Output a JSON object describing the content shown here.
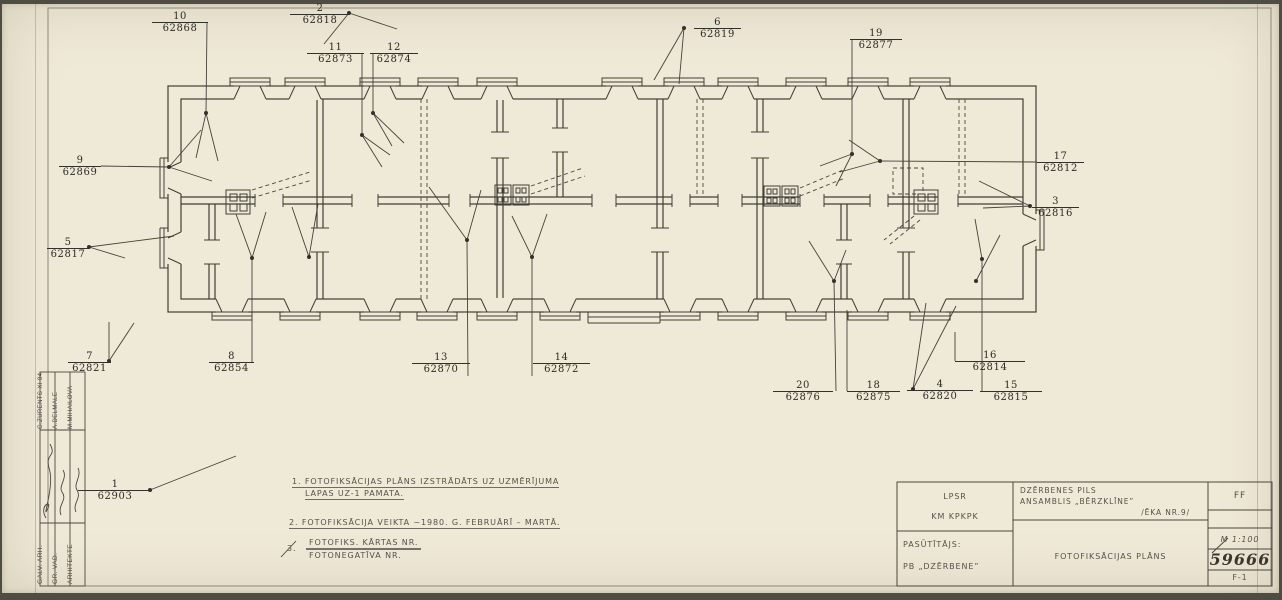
{
  "colors": {
    "paper": "#efe9d8",
    "line": "#413e36",
    "label_text": "#2d2b25",
    "hand_text": "#56524a"
  },
  "photo_points": [
    {
      "n": "1",
      "code": "62903",
      "x": 78,
      "y": 490,
      "w": 74,
      "dot": [
        150,
        490
      ],
      "leaders": [
        [
          [
            150,
            490
          ],
          [
            236,
            456
          ]
        ]
      ]
    },
    {
      "n": "2",
      "code": "62818",
      "x": 290,
      "y": 14,
      "w": 60,
      "dot": [
        349,
        13
      ],
      "leaders": [
        [
          [
            349,
            13
          ],
          [
            324,
            44
          ]
        ],
        [
          [
            349,
            13
          ],
          [
            397,
            29
          ]
        ]
      ]
    },
    {
      "n": "3",
      "code": "62816",
      "x": 1032,
      "y": 207,
      "w": 47,
      "dot": [
        1030,
        206
      ],
      "leaders": [
        [
          [
            1030,
            206
          ],
          [
            979,
            181
          ]
        ],
        [
          [
            1030,
            206
          ],
          [
            983,
            208
          ]
        ]
      ]
    },
    {
      "n": "4",
      "code": "62820",
      "x": 907,
      "y": 390,
      "w": 66,
      "dot": [
        913,
        389
      ],
      "leaders": [
        [
          [
            913,
            389
          ],
          [
            926,
            303
          ]
        ],
        [
          [
            913,
            389
          ],
          [
            956,
            306
          ]
        ]
      ]
    },
    {
      "n": "5",
      "code": "62817",
      "x": 47,
      "y": 248,
      "w": 42,
      "dot": [
        89,
        247
      ],
      "leaders": [
        [
          [
            89,
            247
          ],
          [
            174,
            236
          ]
        ],
        [
          [
            89,
            247
          ],
          [
            125,
            258
          ]
        ]
      ]
    },
    {
      "n": "6",
      "code": "62819",
      "x": 694,
      "y": 28,
      "w": 47,
      "dot": [
        684,
        28
      ],
      "leaders": [
        [
          [
            684,
            28
          ],
          [
            654,
            80
          ]
        ],
        [
          [
            684,
            28
          ],
          [
            679,
            84
          ]
        ]
      ]
    },
    {
      "n": "7",
      "code": "62821",
      "x": 68,
      "y": 362,
      "w": 43,
      "dot": [
        109,
        361
      ],
      "leaders": [
        [
          [
            109,
            361
          ],
          [
            109,
            322
          ]
        ],
        [
          [
            109,
            361
          ],
          [
            134,
            323
          ]
        ]
      ]
    },
    {
      "n": "8",
      "code": "62854",
      "x": 209,
      "y": 362,
      "w": 45,
      "dot": [
        252,
        258
      ],
      "leaders": [
        [
          [
            252,
            362
          ],
          [
            252,
            258
          ]
        ],
        [
          [
            252,
            258
          ],
          [
            236,
            214
          ]
        ],
        [
          [
            252,
            258
          ],
          [
            266,
            212
          ]
        ]
      ]
    },
    {
      "n": "9",
      "code": "62869",
      "x": 59,
      "y": 166,
      "w": 42,
      "dot": [
        169,
        167
      ],
      "leaders": [
        [
          [
            101,
            166
          ],
          [
            169,
            167
          ]
        ],
        [
          [
            169,
            167
          ],
          [
            201,
            130
          ]
        ],
        [
          [
            169,
            167
          ],
          [
            212,
            181
          ]
        ]
      ]
    },
    {
      "n": "10",
      "code": "62868",
      "x": 152,
      "y": 22,
      "w": 56,
      "dot": [
        206,
        113
      ],
      "leaders": [
        [
          [
            207,
            22
          ],
          [
            206,
            113
          ]
        ],
        [
          [
            206,
            113
          ],
          [
            196,
            158
          ]
        ],
        [
          [
            206,
            113
          ],
          [
            218,
            161
          ]
        ]
      ]
    },
    {
      "n": "11",
      "code": "62873",
      "x": 307,
      "y": 53,
      "w": 57,
      "dot": [
        362,
        135
      ],
      "leaders": [
        [
          [
            362,
            53
          ],
          [
            362,
            135
          ]
        ],
        [
          [
            362,
            135
          ],
          [
            390,
            155
          ]
        ],
        [
          [
            362,
            135
          ],
          [
            382,
            167
          ]
        ]
      ]
    },
    {
      "n": "12",
      "code": "62874",
      "x": 370,
      "y": 53,
      "w": 48,
      "dot": [
        373,
        113
      ],
      "leaders": [
        [
          [
            373,
            53
          ],
          [
            373,
            113
          ]
        ],
        [
          [
            373,
            113
          ],
          [
            392,
            146
          ]
        ],
        [
          [
            373,
            113
          ],
          [
            404,
            143
          ]
        ]
      ]
    },
    {
      "n": "13",
      "code": "62870",
      "x": 412,
      "y": 363,
      "w": 58,
      "dot": [
        467,
        240
      ],
      "leaders": [
        [
          [
            468,
            376
          ],
          [
            467,
            240
          ]
        ],
        [
          [
            467,
            240
          ],
          [
            429,
            187
          ]
        ],
        [
          [
            467,
            240
          ],
          [
            481,
            190
          ]
        ]
      ]
    },
    {
      "n": "14",
      "code": "62872",
      "x": 533,
      "y": 363,
      "w": 57,
      "dot": [
        532,
        257
      ],
      "leaders": [
        [
          [
            532,
            376
          ],
          [
            532,
            257
          ]
        ],
        [
          [
            532,
            257
          ],
          [
            512,
            216
          ]
        ],
        [
          [
            532,
            257
          ],
          [
            547,
            214
          ]
        ]
      ]
    },
    {
      "n": "15",
      "code": "62815",
      "x": 980,
      "y": 391,
      "w": 62,
      "dot": null,
      "leaders": []
    },
    {
      "n": "16",
      "code": "62814",
      "x": 955,
      "y": 361,
      "w": 70,
      "dot": [
        982,
        259
      ],
      "leaders": [
        [
          [
            982,
            391
          ],
          [
            982,
            259
          ]
        ],
        [
          [
            982,
            259
          ],
          [
            975,
            219
          ]
        ],
        [
          [
            955,
            361
          ],
          [
            955,
            332
          ]
        ]
      ]
    },
    {
      "n": "17",
      "code": "62812",
      "x": 1037,
      "y": 162,
      "w": 47,
      "dot": [
        880,
        161
      ],
      "leaders": [
        [
          [
            1037,
            162
          ],
          [
            880,
            161
          ]
        ],
        [
          [
            880,
            161
          ],
          [
            840,
            172
          ]
        ],
        [
          [
            880,
            161
          ],
          [
            849,
            140
          ]
        ]
      ]
    },
    {
      "n": "18",
      "code": "62875",
      "x": 847,
      "y": 391,
      "w": 53,
      "dot": null,
      "leaders": [
        [
          [
            847,
            391
          ],
          [
            847,
            310
          ]
        ]
      ]
    },
    {
      "n": "19",
      "code": "62877",
      "x": 850,
      "y": 39,
      "w": 52,
      "dot": [
        852,
        154
      ],
      "leaders": [
        [
          [
            852,
            39
          ],
          [
            852,
            154
          ]
        ],
        [
          [
            852,
            154
          ],
          [
            820,
            166
          ]
        ],
        [
          [
            852,
            154
          ],
          [
            836,
            186
          ]
        ]
      ]
    },
    {
      "n": "20",
      "code": "62876",
      "x": 773,
      "y": 391,
      "w": 60,
      "dot": [
        834,
        281
      ],
      "leaders": [
        [
          [
            836,
            391
          ],
          [
            834,
            281
          ]
        ],
        [
          [
            834,
            281
          ],
          [
            809,
            241
          ]
        ],
        [
          [
            834,
            281
          ],
          [
            846,
            250
          ]
        ]
      ]
    }
  ],
  "notes": {
    "n1a": "1. FOTOFIKSĀCIJAS PLĀNS IZSTRĀDĀTS UZ UZMĒRĪJUMA",
    "n1b": "LAPAS UZ-1 PAMATA.",
    "n2": "2. FOTOFIKSĀCIJA VEIKTA ~1980. G. FEBRUĀRĪ – MARTĀ.",
    "n3_num": "3.",
    "n3_top": "FOTOFIKS. KĀRTAS NR.",
    "n3_bottom": "FOTONEGATĪVA NR."
  },
  "titleblock": {
    "org_line1": "LPSR",
    "org_line2": "KM KPKPK",
    "client_label": "PASŪTĪTĀJS:",
    "client_name": "PB „DZĒRBENE”",
    "project_line1": "DZĒRBENES PILS",
    "project_line2": "ANSAMBLIS „BĒRZKLĪNE”",
    "project_line3": "/ĒKA NR.9/",
    "drawing_title": "FOTOFIKSĀCIJAS PLĀNS",
    "code_top": "FF",
    "scale": "M 1:100",
    "number": "59666",
    "sheet_code": "F-1"
  },
  "signatures": {
    "s1_role": "GALV. ARH.",
    "s1_name": "G.ZURENTS XI 84",
    "s2_role": "GR. VAD.",
    "s2_name": "A.DELMALE",
    "s3_role": "ARHITEKTE",
    "s3_name": "M.MIHAILOVA"
  }
}
